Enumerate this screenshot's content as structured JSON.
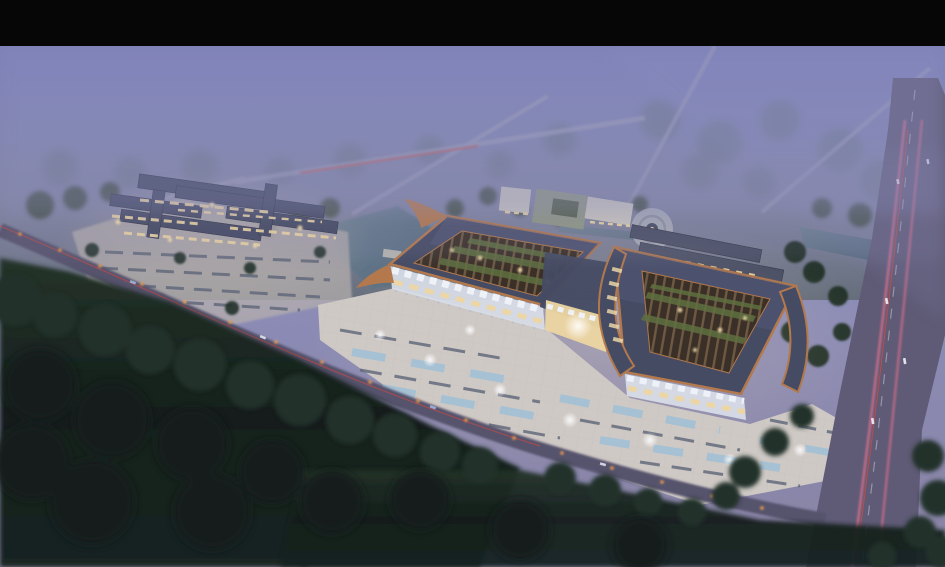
{
  "meta": {
    "type": "architectural-aerial-rendering",
    "time_of_day": "dusk-night",
    "description": "Bird's-eye dusk rendering of a large traditional-roofed market / exhibition complex with illuminated plaza, parking fields, ponds, access roads, a highway with light trails, surrounding farmland forest and fog, letterboxed with a black bar at top."
  },
  "palette": {
    "letterbox": "#060607",
    "sky_top": "#7d80b6",
    "sky_mid": "#8b8cb8",
    "haze_low": "#8a84a4",
    "field_haze": "#7e8494",
    "distant_tree": "#6e7888",
    "mid_tree": "#3e4c3e",
    "dark_tree": "#243329",
    "forest_deep": "#141f1b",
    "ground_dark": "#1a2522",
    "water": "#51667a",
    "water_light": "#6e8294",
    "road": "#56526d",
    "road_light": "#9b9cb8",
    "highway": "#5f5b76",
    "trail_pink": "#e0708e",
    "trail_red": "#c84a44",
    "streetlight": "#e89b4e",
    "plaza": "#cfc9c5",
    "plaza_dim": "#b4aeae",
    "warm_glow": "#f3ddab",
    "cool_white": "#eef2f8",
    "roof_slate": "#454b63",
    "roof_slate_light": "#5c6386",
    "copper": "#b3794d",
    "lattice_brown": "#3a3027",
    "beam_light": "#8a6f52",
    "lattice_green": "#5f7040",
    "facade_white": "#d9dee8",
    "window_warm": "#edd6a2",
    "building_white": "#c9c6bf",
    "pool_blue": "#9fc0d6",
    "park_dash": "#5e6678",
    "column_grey": "#b9c0cf"
  },
  "scene": {
    "elements": [
      {
        "name": "letterbox-top-bar",
        "description": "black cinematic bar, full width, ~46px tall"
      },
      {
        "name": "sky-fog",
        "description": "lavender evening fog fading over distant farmland"
      },
      {
        "name": "background-roads",
        "description": "thin pale country roads receding into mist, one with red tail-light trail"
      },
      {
        "name": "left-market-complex",
        "description": "smaller complex of dark linked roofs with warm lit facades and parking apron"
      },
      {
        "name": "west-exhibition-hall",
        "description": "large hall, slate roof with copper trim and open timber-lattice skylight with planting"
      },
      {
        "name": "east-exhibition-hall",
        "description": "second large hall with sweeping curved copper eave"
      },
      {
        "name": "entrance-atrium",
        "description": "glowing glass entrance linking the two halls, white zigzag canopy"
      },
      {
        "name": "front-plaza",
        "description": "brightly lit paved plaza with fountain pools, parking rows and point lights"
      },
      {
        "name": "central-pond",
        "description": "pond with small deck between left complex and main halls"
      },
      {
        "name": "circular-pavilion-plaza",
        "description": "round stepped plaza with small pavilion north of the halls"
      },
      {
        "name": "row-buildings",
        "description": "three long low buildings in rows northeast of the halls"
      },
      {
        "name": "office-buildings",
        "description": "white mid-rise blocks with green roof courtyard"
      },
      {
        "name": "highway",
        "description": "multi-lane highway on the right with pink/red light trails and cars"
      },
      {
        "name": "access-road",
        "description": "curved access road from left edge to highway junction, lined with streetlights"
      },
      {
        "name": "foreground-forest",
        "description": "dark trees and fields across the bottom foreground"
      }
    ]
  }
}
